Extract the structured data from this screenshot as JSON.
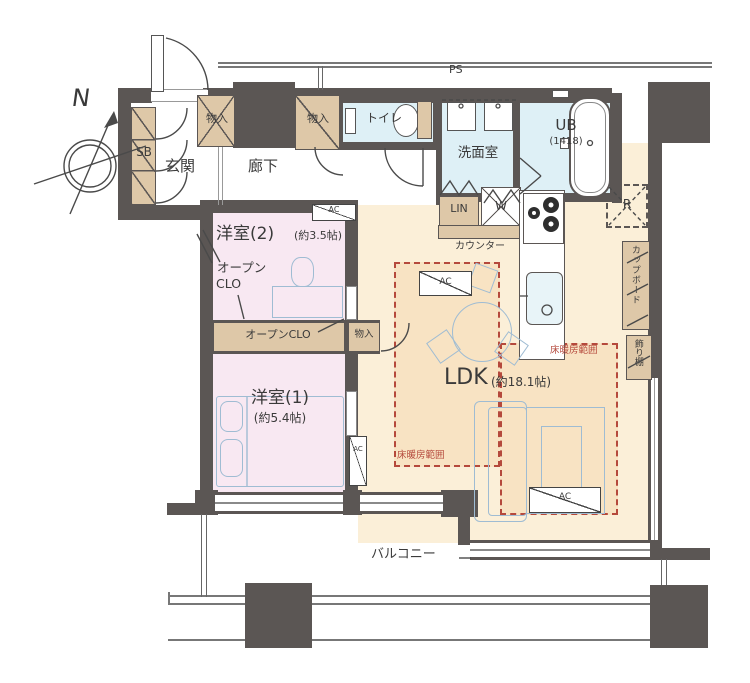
{
  "compass": {
    "north": "N"
  },
  "labels": {
    "ps": "PS",
    "entrance": "玄関",
    "hallway": "廊下",
    "shoe_box": "SB",
    "storage": "物入",
    "toilet": "トイレ",
    "washroom": "洗面室",
    "unit_bath": "UB",
    "unit_bath_size": "(1418)",
    "linen": "LIN",
    "washer": "W",
    "refrigerator": "R",
    "counter": "カウンター",
    "cupboard": "カップボード",
    "display_shelf": "飾り棚",
    "air_conditioner": "AC",
    "open_closet_line1": "オープン",
    "open_closet_line2": "CLO",
    "open_closet": "オープンCLO",
    "floor_heating_area": "床暖房範囲",
    "balcony": "バルコニー"
  },
  "rooms": {
    "bedroom2": {
      "name": "洋室(2)",
      "size": "(約3.5帖)"
    },
    "bedroom1": {
      "name": "洋室(1)",
      "size": "(約5.4帖)"
    },
    "ldk": {
      "name": "LDK",
      "size": "(約18.1帖)"
    }
  },
  "colors": {
    "wall": "#5b5654",
    "bedroom_floor": "#f8e8f2",
    "ldk_floor": "#fbefd8",
    "floor_heating_fill": "#f8e3c3",
    "floor_heating_line": "#b5493c",
    "wet_area_floor": "#def0f6",
    "storage_fill": "#dec8a8",
    "furniture_line": "#9fbcd3"
  }
}
